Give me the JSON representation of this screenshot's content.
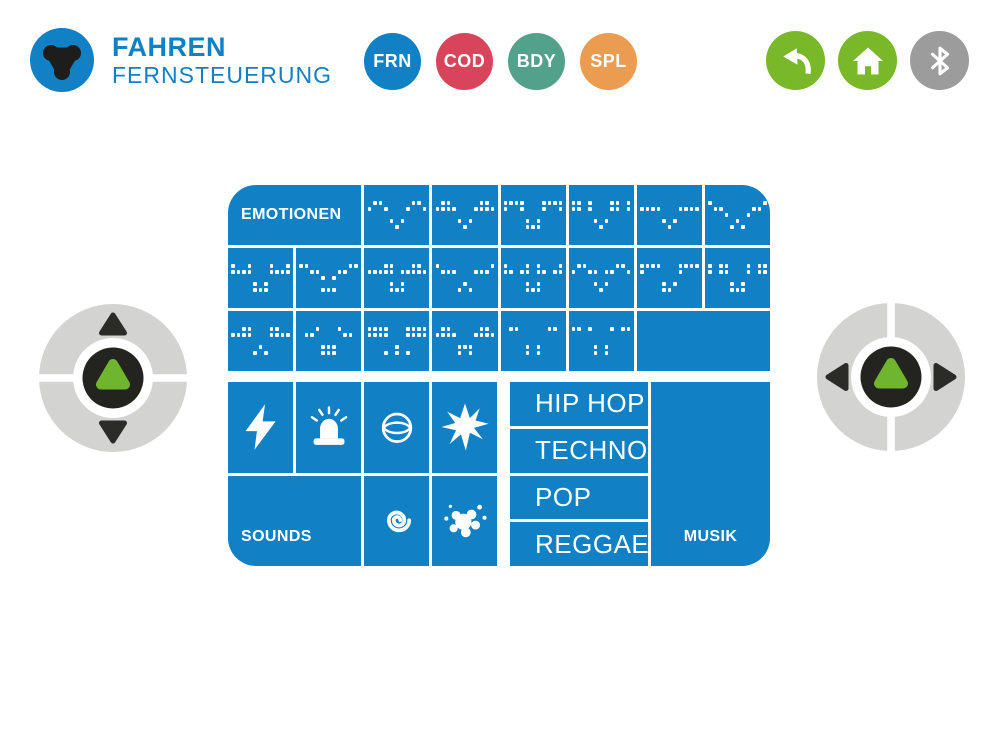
{
  "header": {
    "title": "FAHREN",
    "subtitle": "FERNSTEUERUNG",
    "logo_icon": "tinkerbots-logo",
    "mode_buttons": [
      {
        "label": "FRN",
        "color": "#1180c5"
      },
      {
        "label": "COD",
        "color": "#d8455a"
      },
      {
        "label": "BDY",
        "color": "#53a08b"
      },
      {
        "label": "SPL",
        "color": "#ea9c51"
      }
    ],
    "utility_buttons": [
      {
        "icon": "back-icon",
        "color": "#79b829"
      },
      {
        "icon": "home-icon",
        "color": "#79b829"
      },
      {
        "icon": "bluetooth-icon",
        "color": "#9c9c9c"
      }
    ]
  },
  "dpads": {
    "left": {
      "axis": "vertical",
      "directions": [
        "up",
        "down"
      ],
      "center_icon": "tribot-glyph"
    },
    "right": {
      "axis": "horizontal",
      "directions": [
        "left",
        "right"
      ],
      "center_icon": "tribot-glyph"
    }
  },
  "emotions": {
    "label": "EMOTIONEN",
    "faces": [
      {
        "name": "smile",
        "pattern": [
          ".11.....11.",
          "1..1...1..1",
          "...........",
          "....1.1....",
          ".....1....."
        ]
      },
      {
        "name": "happy",
        "pattern": [
          ".11.....11.",
          "1111...1111",
          "...........",
          "....1.1....",
          ".....1....."
        ]
      },
      {
        "name": "surprised",
        "pattern": [
          "1111...1111",
          "1..1...1..1",
          "...........",
          "....1.1....",
          "....111...."
        ]
      },
      {
        "name": "wide-eyes",
        "pattern": [
          "11.1...11.1",
          "11.1...11.1",
          "...........",
          "....1.1....",
          ".....1....."
        ]
      },
      {
        "name": "neutral",
        "pattern": [
          "...........",
          "1111...1111",
          "...........",
          "....1.1....",
          ".....1....."
        ]
      },
      {
        "name": "sad",
        "pattern": [
          "1.........1",
          ".11.....11.",
          "...1...1...",
          ".....1.....",
          "....1.1...."
        ]
      },
      {
        "name": "grin",
        "pattern": [
          "1..1...1..1",
          "1111...1111",
          "...........",
          "....1.1....",
          "....111...."
        ]
      },
      {
        "name": "relaxed",
        "pattern": [
          "11.......11",
          "..11...11..",
          "....1.1....",
          "...........",
          "....111...."
        ]
      },
      {
        "name": "focused",
        "pattern": [
          "...11...11.",
          "11111.11111",
          "...........",
          "....1.1....",
          "....111...."
        ]
      },
      {
        "name": "worried",
        "pattern": [
          "1.........1",
          ".111...111.",
          "...........",
          ".....1.....",
          "....1.1...."
        ]
      },
      {
        "name": "blink",
        "pattern": [
          "1...1.1...1",
          "11.11.11.11",
          "...........",
          "....1.1....",
          "....111...."
        ]
      },
      {
        "name": "wink",
        "pattern": [
          ".11.....11.",
          "1..11.11..1",
          "...........",
          "....1.1....",
          ".....1....."
        ]
      },
      {
        "name": "confused",
        "pattern": [
          "1111...1111",
          "1......1...",
          "...........",
          "....1.1....",
          "....11....."
        ]
      },
      {
        "name": "pixel-eyes",
        "pattern": [
          "1.11...1.11",
          "1.11...1.11",
          "...........",
          "....1.1....",
          "....111...."
        ]
      },
      {
        "name": "upset",
        "pattern": [
          "..11...11..",
          "1111...1111",
          "...........",
          ".....1.....",
          "....1.1...."
        ]
      },
      {
        "name": "open-mouth",
        "pattern": [
          "...1...1...",
          ".11.....11.",
          "...........",
          "....111....",
          "....111...."
        ]
      },
      {
        "name": "solid-eyes",
        "pattern": [
          "1111...1111",
          "1111...1111",
          "...........",
          ".....1.....",
          "...1.1.1..."
        ]
      },
      {
        "name": "dizzy",
        "pattern": [
          ".11.....11.",
          "1111...1111",
          "...........",
          "....111....",
          "....1.1...."
        ]
      },
      {
        "name": "shy",
        "pattern": [
          ".11.....11.",
          "...........",
          "...........",
          "....1.1....",
          "....1.1...."
        ]
      },
      {
        "name": "tiny-eyes",
        "pattern": [
          "11.1...1.11",
          "...........",
          "...........",
          "....1.1....",
          "....1.1...."
        ]
      }
    ]
  },
  "sounds": {
    "label": "SOUNDS",
    "top_icons": [
      "lightning-icon",
      "siren-icon",
      "ball-icon",
      "burst-icon"
    ],
    "bottom_icons": [
      "spiral-icon",
      "splat-icon"
    ]
  },
  "music": {
    "label": "MUSIK",
    "genres": [
      "HIP HOP",
      "TECHNO",
      "POP",
      "REGGAE"
    ]
  },
  "colors": {
    "panel_blue": "#1180c5",
    "accent_green": "#79b829",
    "glyph_green": "#6fb52e",
    "dpad_gray": "#d3d3d1",
    "dark": "#23231f",
    "bluetooth_gray": "#9c9c9c"
  }
}
